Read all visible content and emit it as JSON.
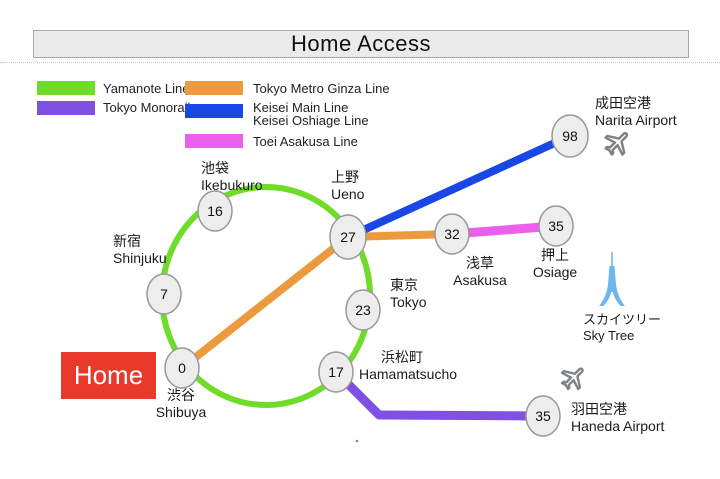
{
  "title": "Home Access",
  "colors": {
    "yamanote": "#6edc29",
    "monorail": "#7e50e3",
    "ginza": "#ec9a3d",
    "keisei": "#1847e6",
    "asakusa_line": "#ec5fec",
    "station_fill": "#ededed",
    "station_border": "#999999",
    "home_red": "#e8392b",
    "plane_gray": "#7f8388",
    "skytree_blue": "#6fb5ee"
  },
  "legend": {
    "yamanote": {
      "label": "Yamanote Line"
    },
    "monorail": {
      "label": "Tokyo Monorail"
    },
    "ginza": {
      "label": "Tokyo Metro Ginza Line"
    },
    "keisei": {
      "label1": "Keisei Main Line",
      "label2": "Keisei Oshiage Line"
    },
    "asakusa": {
      "label": "Toei Asakusa Line"
    }
  },
  "home": {
    "label": "Home"
  },
  "stations": {
    "shibuya": {
      "value": "0",
      "jp": "渋谷",
      "en": "Shibuya"
    },
    "shinjuku": {
      "value": "7",
      "jp": "新宿",
      "en": "Shinjuku"
    },
    "ikebukuro": {
      "value": "16",
      "jp": "池袋",
      "en": "Ikebukuro"
    },
    "ueno": {
      "value": "27",
      "jp": "上野",
      "en": "Ueno"
    },
    "tokyo": {
      "value": "23",
      "jp": "東京",
      "en": "Tokyo"
    },
    "hamamatsucho": {
      "value": "17",
      "jp": "浜松町",
      "en": "Hamamatsucho"
    },
    "asakusa": {
      "value": "32",
      "jp": "浅草",
      "en": "Asakusa"
    },
    "oshiage": {
      "value": "35",
      "jp": "押上",
      "en": "Osiage"
    },
    "narita": {
      "value": "98",
      "jp": "成田空港",
      "en": "Narita Airport"
    },
    "haneda": {
      "value": "35",
      "jp": "羽田空港",
      "en": "Haneda Airport"
    }
  },
  "landmarks": {
    "skytree": {
      "jp": "スカイツリー",
      "en": "Sky Tree"
    }
  }
}
